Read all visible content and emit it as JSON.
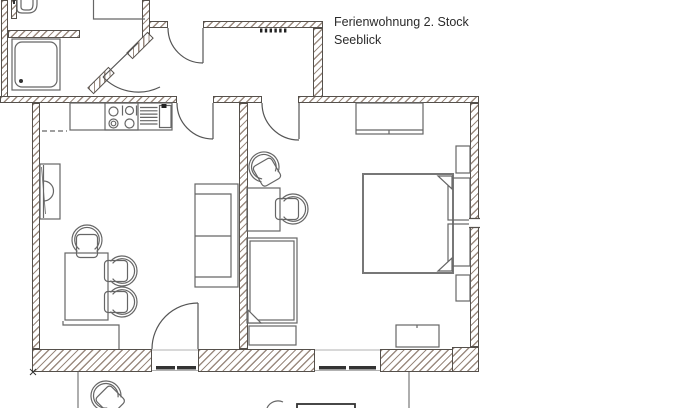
{
  "title": {
    "line1": "Ferienwohnung 2. Stock",
    "line2": "Seeblick"
  },
  "plan": {
    "wall_edge_color": "#55504b",
    "hatch_color": "#9b8b80",
    "line_color": "#666666",
    "walls": [
      {
        "n": "bathroom-left-wall",
        "x": 1,
        "y": 0,
        "w": 7,
        "h": 103
      },
      {
        "n": "bathroom-partition-stub",
        "x": 11,
        "y": 0,
        "w": 6,
        "h": 19
      },
      {
        "n": "bathroom-mid-wall",
        "x": 8,
        "y": 30,
        "w": 72,
        "h": 8
      },
      {
        "n": "entry-hall-wall-vertical",
        "x": 142,
        "y": 0,
        "w": 8,
        "h": 42
      },
      {
        "n": "landing-top-wall-left",
        "x": 149,
        "y": 21,
        "w": 19,
        "h": 7
      },
      {
        "n": "landing-top-wall-right",
        "x": 203,
        "y": 21,
        "w": 120,
        "h": 7
      },
      {
        "n": "landing-right-wall",
        "x": 313,
        "y": 28,
        "w": 10,
        "h": 69
      },
      {
        "n": "hall-south-wall-left",
        "x": 0,
        "y": 96,
        "w": 177,
        "h": 7
      },
      {
        "n": "hall-south-wall-mid",
        "x": 213,
        "y": 96,
        "w": 49,
        "h": 7
      },
      {
        "n": "hall-south-wall-right",
        "x": 298,
        "y": 96,
        "w": 181,
        "h": 7
      },
      {
        "n": "left-exterior-wall",
        "x": 32,
        "y": 103,
        "w": 8,
        "h": 246
      },
      {
        "n": "room-divider-wall",
        "x": 239,
        "y": 103,
        "w": 9,
        "h": 246
      },
      {
        "n": "right-exterior-wall",
        "x": 470,
        "y": 103,
        "w": 9,
        "h": 244
      },
      {
        "n": "bottom-wall-left",
        "x": 32,
        "y": 349,
        "w": 120,
        "h": 23
      },
      {
        "n": "bottom-wall-mid",
        "x": 198,
        "y": 349,
        "w": 117,
        "h": 23
      },
      {
        "n": "bottom-wall-right",
        "x": 380,
        "y": 349,
        "w": 99,
        "h": 23
      },
      {
        "n": "corner-block-bottom-right",
        "x": 452,
        "y": 347,
        "w": 27,
        "h": 25
      },
      {
        "n": "entrance-jamb-lower",
        "x": 86,
        "y": 76,
        "w": 30,
        "h": 9,
        "rot": -45
      },
      {
        "n": "entrance-jamb-upper",
        "x": 125,
        "y": 41,
        "w": 30,
        "h": 9,
        "rot": -45
      }
    ],
    "shapes": [
      {
        "t": "path",
        "n": "wc-sink",
        "a": {
          "d": "M17,0 V9 Q17,13 22,13 H28 Q37,13 37,4 V0"
        }
      },
      {
        "t": "path",
        "n": "wc-sink-inner",
        "a": {
          "d": "M21,0 V7 Q21,10 25,10 H29 Q33,10 33,4 V0"
        }
      },
      {
        "t": "line",
        "n": "wc-sink-tap",
        "a": {
          "x1": 14,
          "y1": 0,
          "x2": 14,
          "y2": 4,
          "stroke": "#333333",
          "stroke-width": 2
        }
      },
      {
        "t": "rect",
        "n": "shower-tray",
        "a": {
          "x": 12,
          "y": 39,
          "width": 48,
          "height": 51
        }
      },
      {
        "t": "rect",
        "n": "shower-tray-inner",
        "a": {
          "x": 15,
          "y": 42,
          "width": 42,
          "height": 45,
          "rx": 7
        }
      },
      {
        "t": "circle",
        "n": "shower-drain",
        "a": {
          "cx": 21,
          "cy": 81,
          "r": 2,
          "fill": "#333333",
          "stroke": "none"
        }
      },
      {
        "t": "path",
        "n": "hall-niche-lines",
        "a": {
          "d": "M93.5,0 V19 H145"
        }
      },
      {
        "t": "rect",
        "n": "stair-mark",
        "a": {
          "x": 260,
          "y": 28.5,
          "width": 2.4,
          "height": 4,
          "fill": "#222222",
          "stroke": "none"
        }
      },
      {
        "t": "rect",
        "n": "stair-mark",
        "a": {
          "x": 264.8,
          "y": 28.5,
          "width": 2.4,
          "height": 4,
          "fill": "#222222",
          "stroke": "none"
        }
      },
      {
        "t": "rect",
        "n": "stair-mark",
        "a": {
          "x": 269.6,
          "y": 28.5,
          "width": 2.4,
          "height": 4,
          "fill": "#222222",
          "stroke": "none"
        }
      },
      {
        "t": "rect",
        "n": "stair-mark",
        "a": {
          "x": 274.4,
          "y": 28.5,
          "width": 2.4,
          "height": 4,
          "fill": "#222222",
          "stroke": "none"
        }
      },
      {
        "t": "rect",
        "n": "stair-mark",
        "a": {
          "x": 279.2,
          "y": 28.5,
          "width": 2.4,
          "height": 4,
          "fill": "#222222",
          "stroke": "none"
        }
      },
      {
        "t": "rect",
        "n": "stair-mark",
        "a": {
          "x": 284,
          "y": 28.5,
          "width": 2.4,
          "height": 4,
          "fill": "#222222",
          "stroke": "none"
        }
      },
      {
        "t": "rect",
        "n": "kitchen-counter",
        "a": {
          "x": 70,
          "y": 103,
          "width": 102,
          "height": 27
        }
      },
      {
        "t": "rect",
        "n": "stove-unit",
        "a": {
          "x": 105,
          "y": 103,
          "width": 33,
          "height": 27
        }
      },
      {
        "t": "circle",
        "n": "stove-burner",
        "a": {
          "cx": 113.5,
          "cy": 111.5,
          "r": 4.5
        }
      },
      {
        "t": "circle",
        "n": "stove-burner",
        "a": {
          "cx": 129.5,
          "cy": 110.5,
          "r": 4
        }
      },
      {
        "t": "path",
        "n": "stove-burner-brackets",
        "a": {
          "d": "M122.5,105.5 V115.5 M136.5,105.5 V115.5"
        }
      },
      {
        "t": "circle",
        "n": "stove-burner",
        "a": {
          "cx": 113.5,
          "cy": 123.5,
          "r": 4.5
        }
      },
      {
        "t": "circle",
        "n": "stove-burner",
        "a": {
          "cx": 113.5,
          "cy": 123.5,
          "r": 2.3
        }
      },
      {
        "t": "circle",
        "n": "stove-burner",
        "a": {
          "cx": 129.5,
          "cy": 123.5,
          "r": 4.5
        }
      },
      {
        "t": "path",
        "n": "sink-drainer-lines",
        "a": {
          "d": "M140,107.5 H157.5 M140,110.8 H157.5 M140,114.1 H157.5 M140,117.4 H157.5 M140,120.7 H157.5 M140,124 H157.5"
        }
      },
      {
        "t": "rect",
        "n": "sink-basin",
        "a": {
          "x": 159.5,
          "y": 105.5,
          "width": 11.5,
          "height": 22
        }
      },
      {
        "t": "rect",
        "n": "sink-faucet",
        "a": {
          "x": 161.5,
          "y": 104,
          "width": 5,
          "height": 4,
          "fill": "#222222",
          "stroke": "none"
        }
      },
      {
        "t": "path",
        "n": "kitchen-dashed-line",
        "a": {
          "d": "M42,131 H67",
          "stroke-dasharray": "5,3"
        }
      },
      {
        "t": "rect",
        "n": "tv-cabinet",
        "a": {
          "x": 40,
          "y": 164,
          "width": 20,
          "height": 55
        }
      },
      {
        "t": "path",
        "n": "tv-line",
        "a": {
          "d": "M43.5,165 V218"
        }
      },
      {
        "t": "path",
        "n": "tv-screen-arc",
        "a": {
          "d": "M43.5,181 A10,10 0 0 1 43.5,201"
        }
      },
      {
        "t": "path",
        "n": "tv-diagonal",
        "a": {
          "d": "M41.5,167 L45.5,214",
          "stroke-width": 0.8
        }
      },
      {
        "t": "rect",
        "n": "sofa",
        "a": {
          "x": 195,
          "y": 184,
          "width": 43,
          "height": 103
        }
      },
      {
        "t": "path",
        "n": "sofa-cushion-lines",
        "a": {
          "d": "M195,194 H231 V277 H195 M195,236 H231"
        }
      },
      {
        "t": "rect",
        "n": "dining-table",
        "a": {
          "x": 65,
          "y": 253,
          "width": 43,
          "height": 67
        }
      },
      {
        "t": "chair",
        "n": "dining-chair-top",
        "a": {
          "transform": "translate(87,240) rotate(-90)"
        }
      },
      {
        "t": "chair",
        "n": "dining-chair-right-1",
        "a": {
          "transform": "translate(122,271)"
        }
      },
      {
        "t": "chair",
        "n": "dining-chair-right-2",
        "a": {
          "transform": "translate(122,302)"
        }
      },
      {
        "t": "path",
        "n": "floor-step-line",
        "a": {
          "d": "M63,321 V325 H119 V349"
        }
      },
      {
        "t": "rect",
        "n": "desk",
        "a": {
          "x": 247,
          "y": 188,
          "width": 33,
          "height": 43
        }
      },
      {
        "t": "chair",
        "n": "desk-chair",
        "a": {
          "transform": "translate(293,209)"
        }
      },
      {
        "t": "chair",
        "n": "bedroom-loose-chair",
        "a": {
          "transform": "translate(264,167) rotate(-120)"
        }
      },
      {
        "t": "rect",
        "n": "single-bed",
        "a": {
          "x": 247,
          "y": 238,
          "width": 50,
          "height": 85
        }
      },
      {
        "t": "rect",
        "n": "single-bed-mattress",
        "a": {
          "x": 250,
          "y": 241,
          "width": 44,
          "height": 79
        }
      },
      {
        "t": "path",
        "n": "single-bed-fold",
        "a": {
          "d": "M248,310 L261,323 H248 Z",
          "fill": "#ffffff"
        }
      },
      {
        "t": "rect",
        "n": "single-bed-footboard",
        "a": {
          "x": 249,
          "y": 326,
          "width": 47,
          "height": 19
        }
      },
      {
        "t": "rect",
        "n": "double-bed",
        "a": {
          "x": 363,
          "y": 174,
          "width": 90,
          "height": 99,
          "stroke": "#777777",
          "stroke-width": 2
        }
      },
      {
        "t": "rect",
        "n": "pillow",
        "a": {
          "x": 448,
          "y": 178,
          "width": 22,
          "height": 42
        }
      },
      {
        "t": "rect",
        "n": "pillow",
        "a": {
          "x": 448,
          "y": 224,
          "width": 22,
          "height": 42
        }
      },
      {
        "t": "path",
        "n": "blanket-fold",
        "a": {
          "d": "M452,176 L438,176 L452,189 Z",
          "fill": "#ffffff"
        }
      },
      {
        "t": "path",
        "n": "blanket-fold",
        "a": {
          "d": "M452,271 L438,271 L452,258 Z",
          "fill": "#ffffff"
        }
      },
      {
        "t": "rect",
        "n": "nightstand",
        "a": {
          "x": 456,
          "y": 146,
          "width": 14,
          "height": 27
        }
      },
      {
        "t": "rect",
        "n": "nightstand",
        "a": {
          "x": 456,
          "y": 275,
          "width": 14,
          "height": 26
        }
      },
      {
        "t": "rect",
        "n": "wardrobe",
        "a": {
          "x": 356,
          "y": 103,
          "width": 67,
          "height": 31
        }
      },
      {
        "t": "path",
        "n": "wardrobe-detail",
        "a": {
          "d": "M356,130 H423 M389,130 V134"
        }
      },
      {
        "t": "rect",
        "n": "dresser",
        "a": {
          "x": 396,
          "y": 325,
          "width": 43,
          "height": 22
        }
      },
      {
        "t": "path",
        "n": "dresser-detail",
        "a": {
          "d": "M417,325 V328"
        }
      },
      {
        "t": "path",
        "n": "living-room-door-leaf",
        "a": {
          "d": "M213,103 V139",
          "stroke": "#555555"
        }
      },
      {
        "t": "path",
        "n": "living-room-door-arc",
        "a": {
          "d": "M177,103 A36,36 0 0 0 213,139",
          "stroke": "#555555"
        }
      },
      {
        "t": "path",
        "n": "bedroom-door-leaf",
        "a": {
          "d": "M299,103 V139",
          "stroke": "#555555"
        }
      },
      {
        "t": "path",
        "n": "bedroom-door-arc",
        "a": {
          "d": "M262,103 A37,37 0 0 0 299,140",
          "stroke": "#555555"
        }
      },
      {
        "t": "path",
        "n": "landing-door-leaf",
        "a": {
          "d": "M203,28 V63",
          "stroke": "#555555"
        }
      },
      {
        "t": "path",
        "n": "landing-door-arc",
        "a": {
          "d": "M168,28 A35,35 0 0 0 203,63",
          "stroke": "#555555"
        }
      },
      {
        "t": "path",
        "n": "balcony-door-leaf",
        "a": {
          "d": "M198,303 V349",
          "stroke": "#555555"
        }
      },
      {
        "t": "path",
        "n": "balcony-door-arc",
        "a": {
          "d": "M152,349 A46,46 0 0 1 198,303",
          "stroke": "#555555"
        }
      },
      {
        "t": "path",
        "n": "entrance-door-leaf",
        "a": {
          "d": "M103,77 L138,43",
          "stroke": "#555555"
        }
      },
      {
        "t": "path",
        "n": "entrance-door-arc",
        "a": {
          "d": "M103,77 A49,49 0 0 0 160,87",
          "stroke": "#555555"
        }
      },
      {
        "t": "path",
        "n": "balcony-door-edges",
        "a": {
          "d": "M152,350 H198 M152,370.5 H198",
          "stroke": "#999999",
          "stroke-width": 0.8
        }
      },
      {
        "t": "rect",
        "n": "balcony-door-track",
        "a": {
          "x": 156,
          "y": 366,
          "width": 19,
          "height": 3.5,
          "fill": "#333333",
          "stroke": "none"
        }
      },
      {
        "t": "rect",
        "n": "balcony-door-track",
        "a": {
          "x": 177,
          "y": 366,
          "width": 19,
          "height": 3.5,
          "fill": "#333333",
          "stroke": "none"
        }
      },
      {
        "t": "path",
        "n": "bedroom-window-edges",
        "a": {
          "d": "M315,350 H380 M315,370.5 H380",
          "stroke": "#999999",
          "stroke-width": 0.8
        }
      },
      {
        "t": "rect",
        "n": "bedroom-window-sash",
        "a": {
          "x": 319,
          "y": 366,
          "width": 27,
          "height": 3.5,
          "fill": "#333333",
          "stroke": "none"
        }
      },
      {
        "t": "rect",
        "n": "bedroom-window-sash",
        "a": {
          "x": 349,
          "y": 366,
          "width": 27,
          "height": 3.5,
          "fill": "#333333",
          "stroke": "none"
        }
      },
      {
        "t": "rect",
        "n": "side-window-gap",
        "a": {
          "x": 469,
          "y": 218.5,
          "width": 11,
          "height": 9,
          "fill": "#ffffff",
          "stroke": "none"
        }
      },
      {
        "t": "path",
        "n": "side-window-lines",
        "a": {
          "d": "M469,218.5 H480 M469,227.5 H480",
          "stroke": "#55504b"
        }
      },
      {
        "t": "path",
        "n": "balcony-rail-left",
        "a": {
          "d": "M78,372 V408",
          "stroke": "#777777"
        }
      },
      {
        "t": "path",
        "n": "balcony-rail-right",
        "a": {
          "d": "M409,372 V408",
          "stroke": "#777777"
        }
      },
      {
        "t": "rect",
        "n": "balcony-table",
        "a": {
          "x": 297,
          "y": 404,
          "width": 58,
          "height": 7,
          "stroke": "#333333",
          "stroke-width": 1.8
        }
      },
      {
        "t": "path",
        "n": "balcony-chair-fragment",
        "a": {
          "d": "M267,408 A12,12 0 0 1 283,402"
        }
      },
      {
        "t": "chair",
        "n": "balcony-chair",
        "a": {
          "transform": "translate(106,396) rotate(-135)"
        }
      },
      {
        "t": "path",
        "n": "corner-x-mark",
        "a": {
          "d": "M30,369 L36,375 M36,369 L30,375",
          "stroke": "#333333",
          "stroke-width": 1
        }
      }
    ]
  }
}
